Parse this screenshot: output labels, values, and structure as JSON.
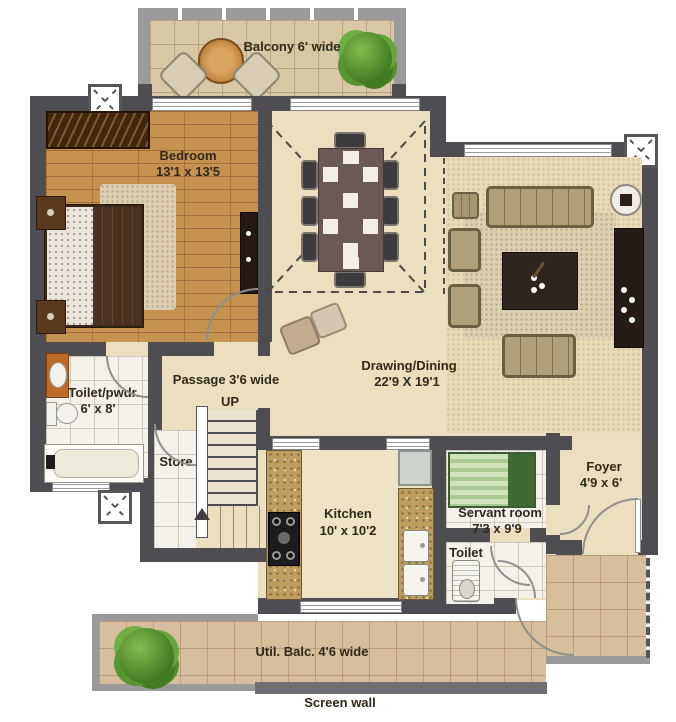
{
  "title": "Apartment floor plan",
  "rooms": {
    "balcony": {
      "label": "Balcony 6' wide"
    },
    "bedroom": {
      "name": "Bedroom",
      "dim": "13'1 x 13'5"
    },
    "toilet_pwdr": {
      "name": "Toilet/pwdr.",
      "dim": "6' x 8'"
    },
    "passage": {
      "label": "Passage 3'6 wide",
      "up": "UP"
    },
    "store": {
      "name": "Store"
    },
    "kitchen": {
      "name": "Kitchen",
      "dim": "10' x 10'2"
    },
    "drawing_dining": {
      "name": "Drawing/Dining",
      "dim": "22'9 X 19'1"
    },
    "servant_room": {
      "name": "Servant room",
      "dim": "7'3 x 9'9"
    },
    "servant_toilet": {
      "name": "Toilet"
    },
    "foyer": {
      "name": "Foyer",
      "dim": "4'9 x 6'"
    },
    "util_balcony": {
      "label": "Util. Balc. 4'6 wide"
    },
    "screen_wall": {
      "label": "Screen wall"
    }
  },
  "palette": {
    "wall": "#4e4e52",
    "light_wall": "#9a9a9a",
    "wood_floor": "#c6924f",
    "tile_floor": "#ecdfbf",
    "white_tile": "#f4f1ea",
    "granite_counter": "#bd9d60",
    "balcony_floor": "#d9c8a6",
    "utility_floor": "#d7bf9d",
    "sofa": "#b1a077",
    "dark_furniture": "#2b2118",
    "servant_bed_green": "#b7d2a8",
    "plant_green": "#4e8a2b",
    "label_text": "#30281a"
  }
}
